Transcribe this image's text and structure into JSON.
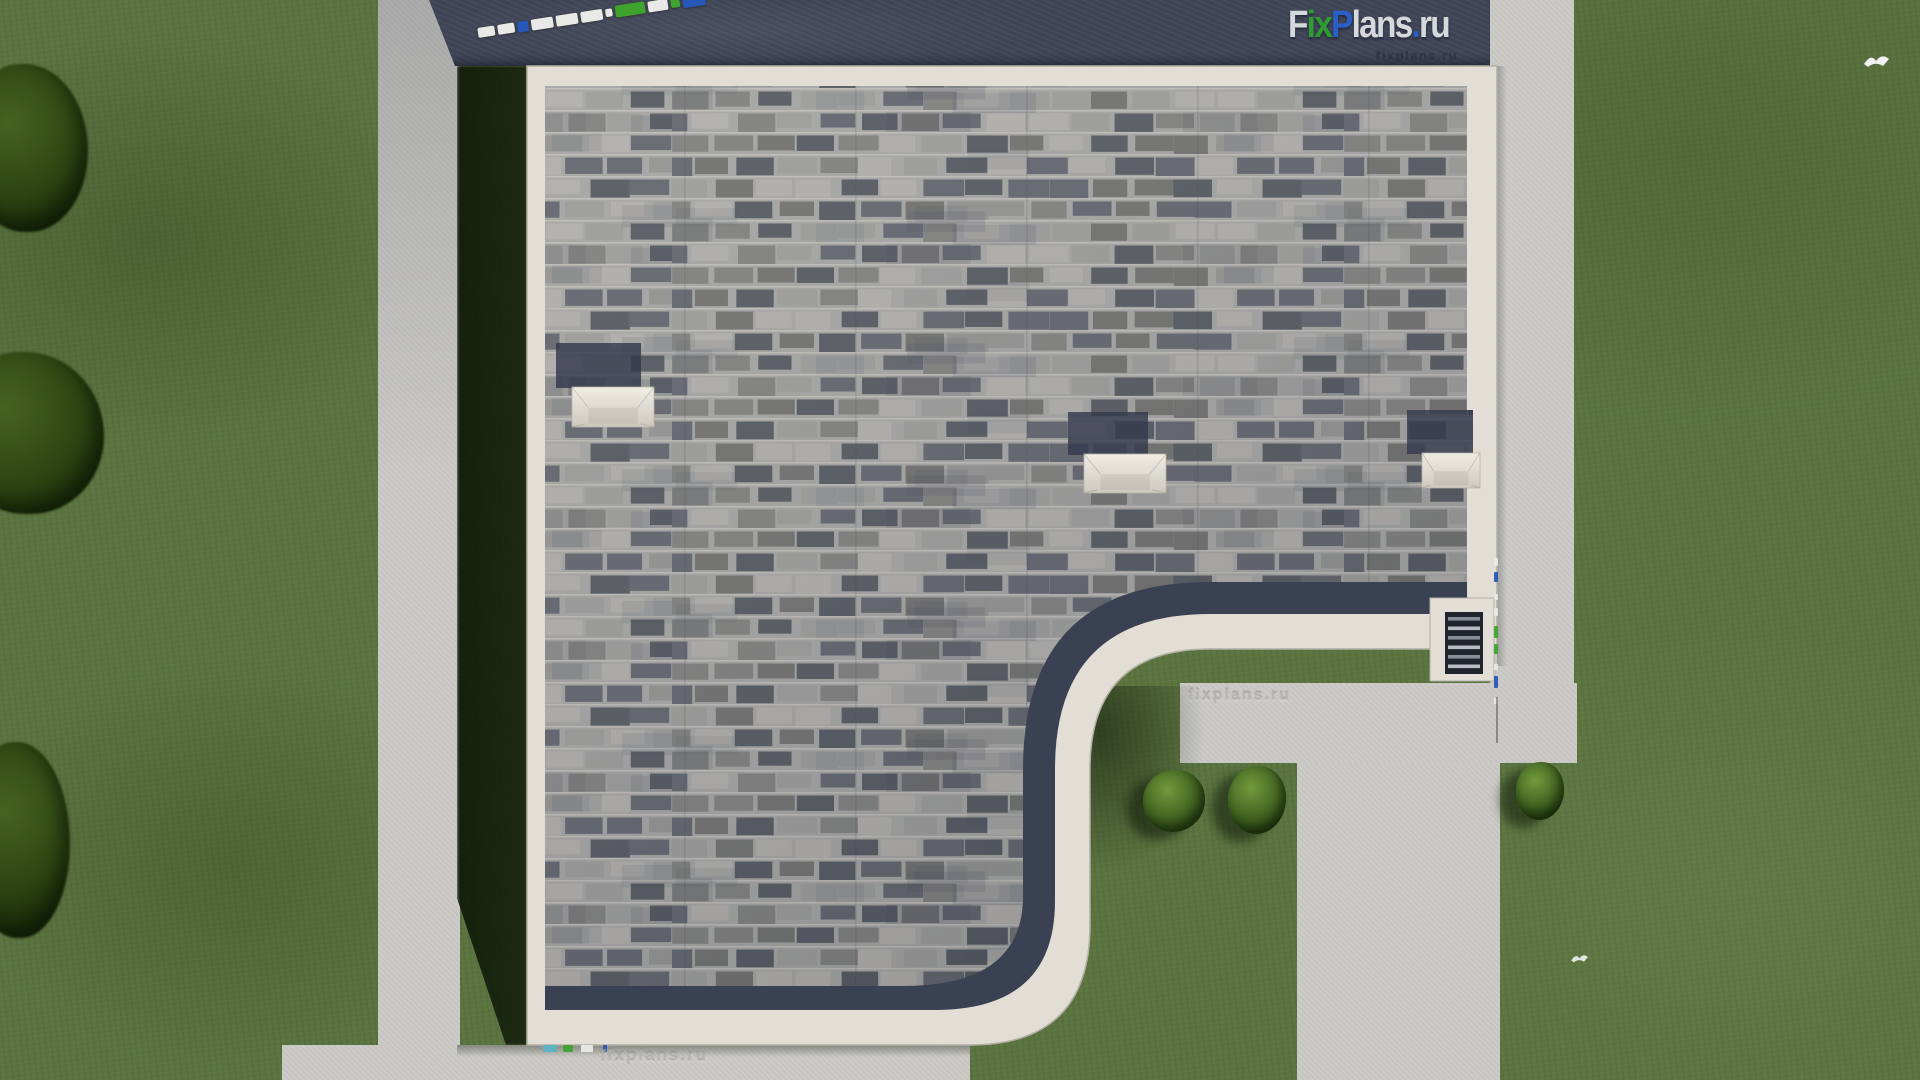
{
  "site": {
    "brand": "FixPlans.ru"
  },
  "logo": {
    "text": "FixPlans.ru",
    "parts": [
      {
        "text": "F",
        "color": "logo_gray"
      },
      {
        "text": "ix",
        "color": "logo_green"
      },
      {
        "text": "P",
        "color": "logo_blue"
      },
      {
        "text": "lans",
        "color": "logo_gray"
      },
      {
        "text": ".",
        "color": "logo_blue"
      },
      {
        "text": "ru",
        "color": "logo_gray"
      }
    ]
  },
  "watermarks": {
    "under_logo": "fixplans.ru",
    "walkway": "fixplans.ru",
    "bottom_path": "fixplans.ru"
  },
  "scalebar": {
    "segments": [
      {
        "w": 17,
        "h": 10,
        "color": "white"
      },
      {
        "w": 17,
        "h": 10,
        "color": "white"
      },
      {
        "w": 11,
        "h": 11,
        "color": "blue"
      },
      {
        "w": 22,
        "h": 11,
        "color": "white"
      },
      {
        "w": 22,
        "h": 11,
        "color": "white"
      },
      {
        "w": 22,
        "h": 11,
        "color": "white"
      },
      {
        "w": 7,
        "h": 8,
        "color": "white"
      },
      {
        "w": 30,
        "h": 12,
        "color": "green"
      },
      {
        "w": 20,
        "h": 11,
        "color": "white"
      },
      {
        "w": 9,
        "h": 10,
        "color": "green"
      },
      {
        "w": 23,
        "h": 14,
        "color": "blue"
      }
    ]
  },
  "edge_strip": {
    "segments": [
      {
        "h": 8,
        "gap": 6,
        "color": "white"
      },
      {
        "h": 10,
        "gap": 12,
        "color": "blue"
      },
      {
        "h": 6,
        "gap": 8,
        "color": "white"
      },
      {
        "h": 8,
        "gap": 10,
        "color": "white"
      },
      {
        "h": 12,
        "gap": 6,
        "color": "green"
      },
      {
        "h": 10,
        "gap": 10,
        "color": "green"
      },
      {
        "h": 6,
        "gap": 6,
        "color": "white"
      },
      {
        "h": 12,
        "gap": 10,
        "color": "blue"
      },
      {
        "h": 6,
        "gap": 0,
        "color": "white"
      }
    ]
  },
  "bottom_strip": {
    "segments": [
      {
        "x": 0,
        "w": 14,
        "color": "teal"
      },
      {
        "x": 20,
        "w": 10,
        "color": "green"
      },
      {
        "x": 38,
        "w": 12,
        "color": "white"
      },
      {
        "x": 60,
        "w": 4,
        "color": "blue"
      }
    ]
  },
  "colors": {
    "grass": "#5b7440",
    "grass_shadow": "#16230d",
    "concrete": "#cbcac6",
    "band": "#3e4456",
    "eave": "#e2ded5",
    "trim": "#3a4153",
    "shingle_base": "#a3a3a1",
    "skylight_dark": "#343b4e",
    "frame_light": "#e3dfd6",
    "hatch_dark": "#20242c",
    "bar_white": "#e9e9e7",
    "bar_blue": "#2757b8",
    "bar_green": "#3fa32e",
    "bar_teal": "#5ab4c4",
    "logo_gray": "#d6d9dc",
    "logo_green": "#2f9b33",
    "logo_blue": "#2b5ec7",
    "bird": "#f0f2f3"
  }
}
